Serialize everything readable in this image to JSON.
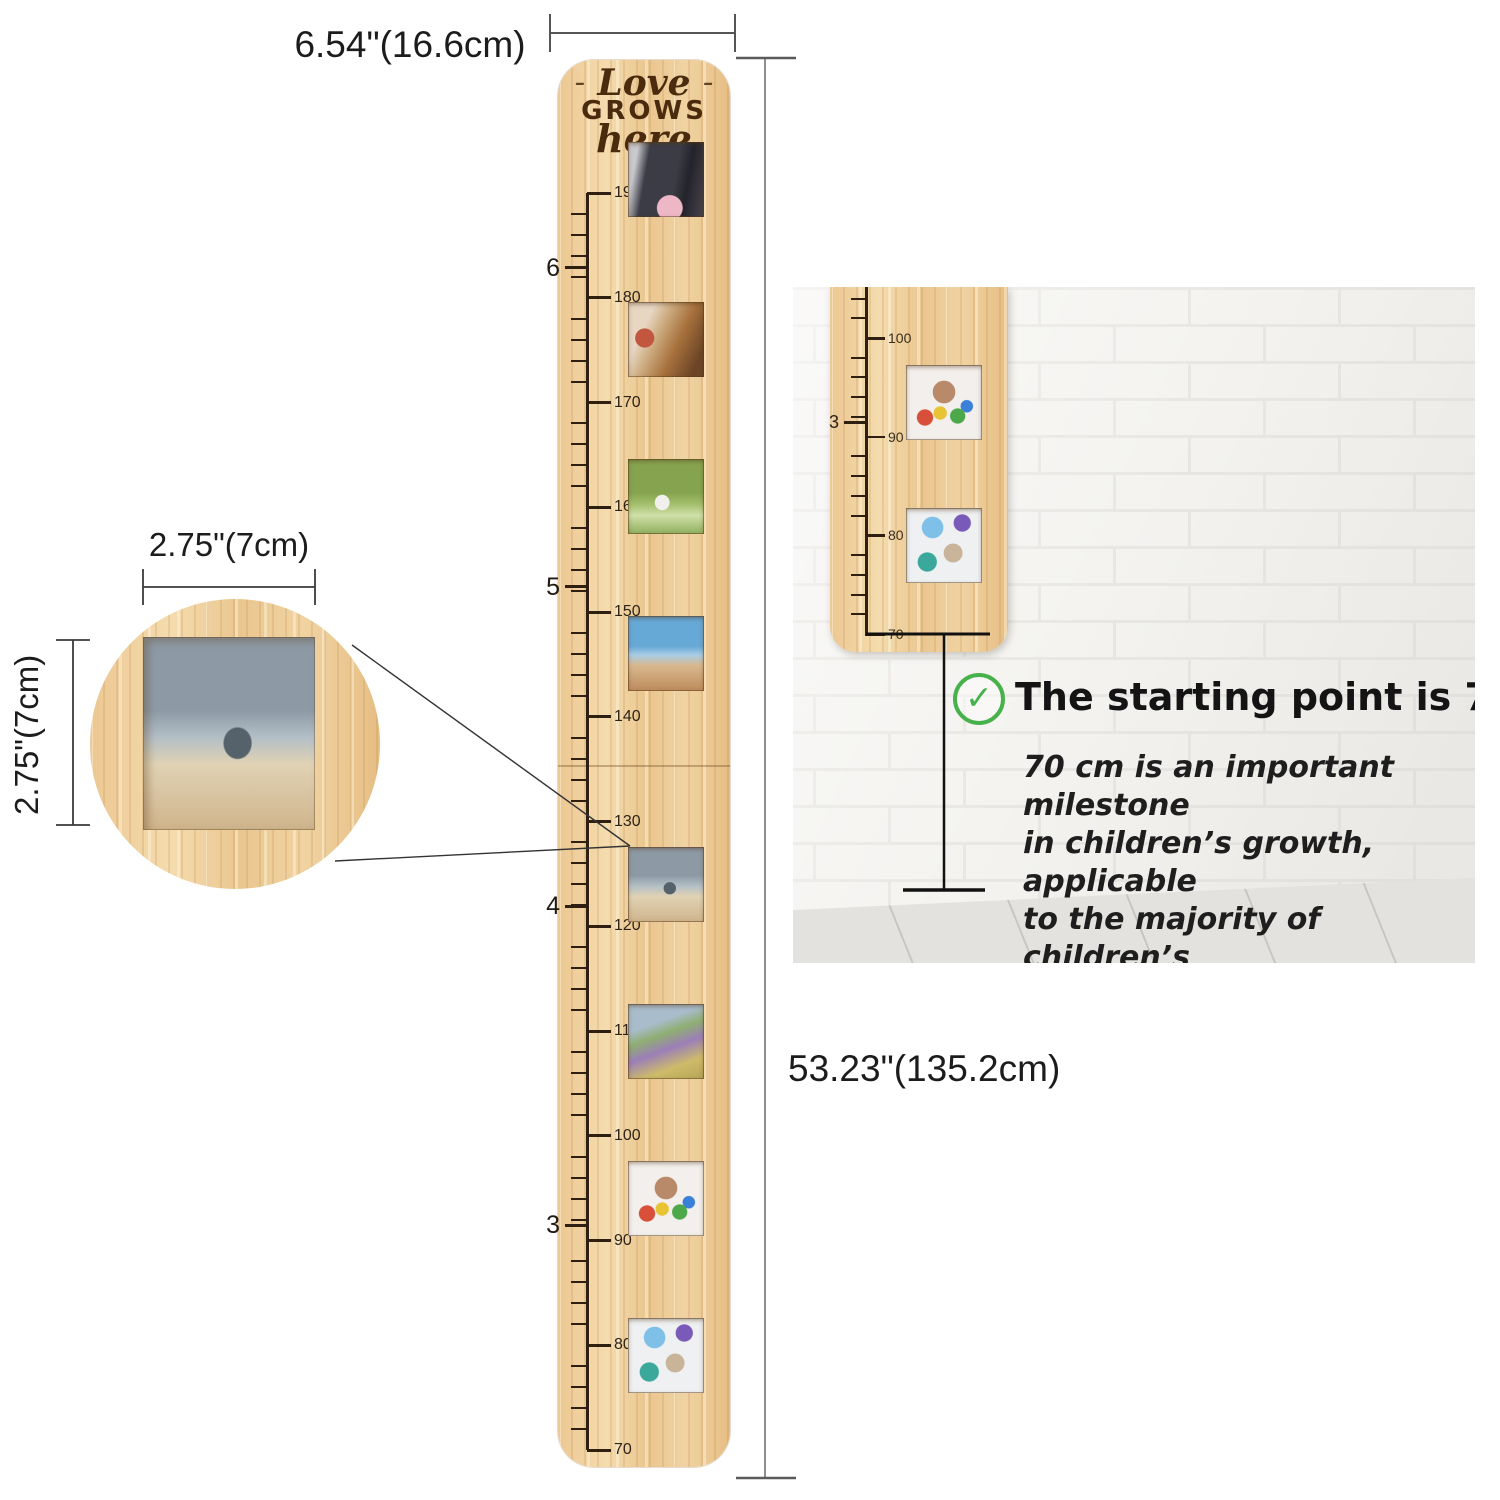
{
  "annotations": {
    "top_width": "6.54\"(16.6cm)",
    "total_height": "53.23\"(135.2cm)",
    "inset_width": "2.75\"(7cm)",
    "inset_height": "2.75\"(7cm)"
  },
  "board": {
    "engraving_line1": "Love",
    "engraving_line2": "GROWS",
    "engraving_line3": "here",
    "engraving_decor": "–",
    "ruler": {
      "unit": "cm",
      "min_cm": 70,
      "max_cm": 190,
      "minor_step_cm": 2,
      "major_step_cm": 10,
      "major_labels": [
        190,
        180,
        170,
        160,
        150,
        140,
        130,
        120,
        110,
        100,
        90,
        80,
        70
      ],
      "feet_marks": [
        {
          "label": "6",
          "cm": 182.88
        },
        {
          "label": "5",
          "cm": 152.4
        },
        {
          "label": "4",
          "cm": 121.92
        },
        {
          "label": "3",
          "cm": 91.44
        }
      ]
    },
    "photos": [
      {
        "name": "graduation-photo",
        "cm": 191.3
      },
      {
        "name": "birthday-candles-photo",
        "cm": 176
      },
      {
        "name": "marathon-runner-photo",
        "cm": 161
      },
      {
        "name": "travel-photo",
        "cm": 146
      },
      {
        "name": "school-girl-photo",
        "cm": 124
      },
      {
        "name": "walk-to-school-photo",
        "cm": 109
      },
      {
        "name": "painted-hands-photo",
        "cm": 94
      },
      {
        "name": "baby-birthday-photo",
        "cm": 79
      }
    ]
  },
  "inset": {
    "photo_name": "school-girl-photo"
  },
  "wall_panel": {
    "check_glyph": "✓",
    "headline": "The starting point is 70 cm.",
    "body_lines": [
      "70 cm is an important milestone",
      "in children’s growth, applicable",
      "to the majority of children’s",
      "developmental stages."
    ],
    "ruler": {
      "unit": "cm",
      "min_cm": 70,
      "max_cm": 104,
      "minor_step_cm": 2,
      "major_step_cm": 10,
      "major_labels": [
        100,
        90,
        80,
        70
      ],
      "feet_marks": [
        {
          "label": "3",
          "cm": 91.44
        }
      ]
    },
    "photos": [
      {
        "name": "painted-hands-photo",
        "cm": 93.5
      },
      {
        "name": "baby-birthday-photo",
        "cm": 79
      }
    ]
  },
  "colors": {
    "check_green": "#47b14b",
    "tick_brown": "#2e1f10",
    "dimension_gray": "#555555",
    "measure_black": "#111111"
  }
}
